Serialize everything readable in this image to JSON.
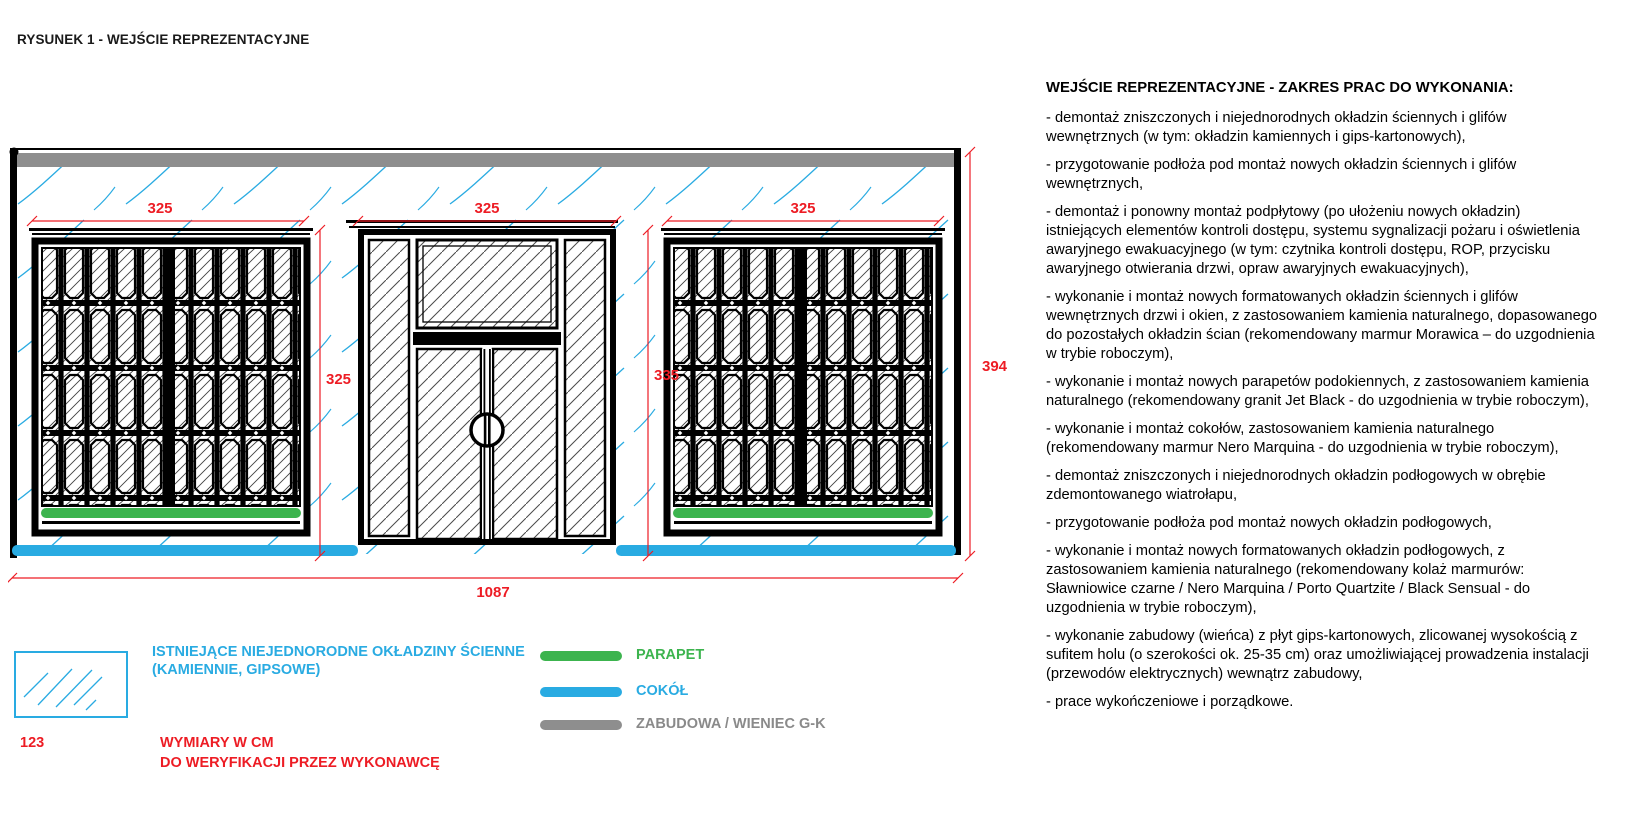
{
  "page_title": "RYSUNEK 1 - WEJŚCIE REPREZENTACYJNE",
  "drawing": {
    "dims": {
      "bay1": "325",
      "bay2": "325",
      "bay3": "325",
      "window_height": "325",
      "door_height": "335",
      "total_height": "394",
      "total_width": "1087"
    },
    "colors": {
      "dimension_red": "#ed1c24",
      "hatch_blue": "#29abe2",
      "parapet_green": "#3cb44e",
      "cokol_blue": "#29abe2",
      "zabudowa_gray": "#8e8e8e"
    }
  },
  "legend": {
    "wall_finishes_line1": "ISTNIEJĄCE NIEJEDNORODNE OKŁADZINY ŚCIENNE",
    "wall_finishes_line2": "(KAMIENNIE, GIPSOWE)",
    "parapet_label": "PARAPET",
    "cokol_label": "COKÓŁ",
    "zabudowa_label": "ZABUDOWA / WIENIEC G-K",
    "sample_dimension": "123",
    "dimensions_note_line1": "WYMIARY W CM",
    "dimensions_note_line2": "DO WERYFIKACJI PRZEZ WYKONAWCĘ"
  },
  "scope": {
    "title": "WEJŚCIE REPREZENTACYJNE - ZAKRES PRAC DO WYKONANIA:",
    "items": [
      "- demontaż zniszczonych i niejednorodnych okładzin ściennych i glifów wewnętrznych (w tym: okładzin kamiennych i gips-kartonowych),",
      "- przygotowanie podłoża pod montaż nowych okładzin ściennych i glifów wewnętrznych,",
      "- demontaż i ponowny montaż podpłytowy (po ułożeniu nowych okładzin) istniejących elementów kontroli dostępu, systemu sygnalizacji pożaru i oświetlenia awaryjnego ewakuacyjnego (w tym: czytnika kontroli dostępu, ROP, przycisku awaryjnego otwierania drzwi, opraw awaryjnych ewakuacyjnych),",
      "- wykonanie i montaż nowych formatowanych okładzin ściennych i glifów wewnętrznych drzwi i okien, z zastosowaniem kamienia naturalnego, dopasowanego do pozostałych okładzin ścian (rekomendowany marmur Morawica – do uzgodnienia w trybie roboczym),",
      "- wykonanie i montaż nowych parapetów podokiennych, z zastosowaniem kamienia naturalnego (rekomendowany granit Jet Black - do uzgodnienia w trybie roboczym),",
      "- wykonanie i montaż cokołów, zastosowaniem kamienia naturalnego (rekomendowany marmur Nero Marquina - do uzgodnienia w trybie roboczym),",
      "- demontaż zniszczonych i niejednorodnych okładzin podłogowych w obrębie zdemontowanego wiatrołapu,",
      "- przygotowanie podłoża pod montaż nowych okładzin podłogowych,",
      "- wykonanie i montaż nowych formatowanych okładzin podłogowych, z zastosowaniem kamienia naturalnego (rekomendowany kolaż marmurów: Sławniowice czarne / Nero Marquina / Porto Quartzite / Black Sensual - do uzgodnienia w trybie roboczym),",
      "- wykonanie zabudowy (wieńca) z płyt gips-kartonowych, zlicowanej wysokością z sufitem holu (o szerokości ok. 25-35 cm) oraz umożliwiającej prowadzenia instalacji (przewodów elektrycznych) wewnątrz zabudowy,",
      "- prace wykończeniowe i porządkowe."
    ]
  }
}
